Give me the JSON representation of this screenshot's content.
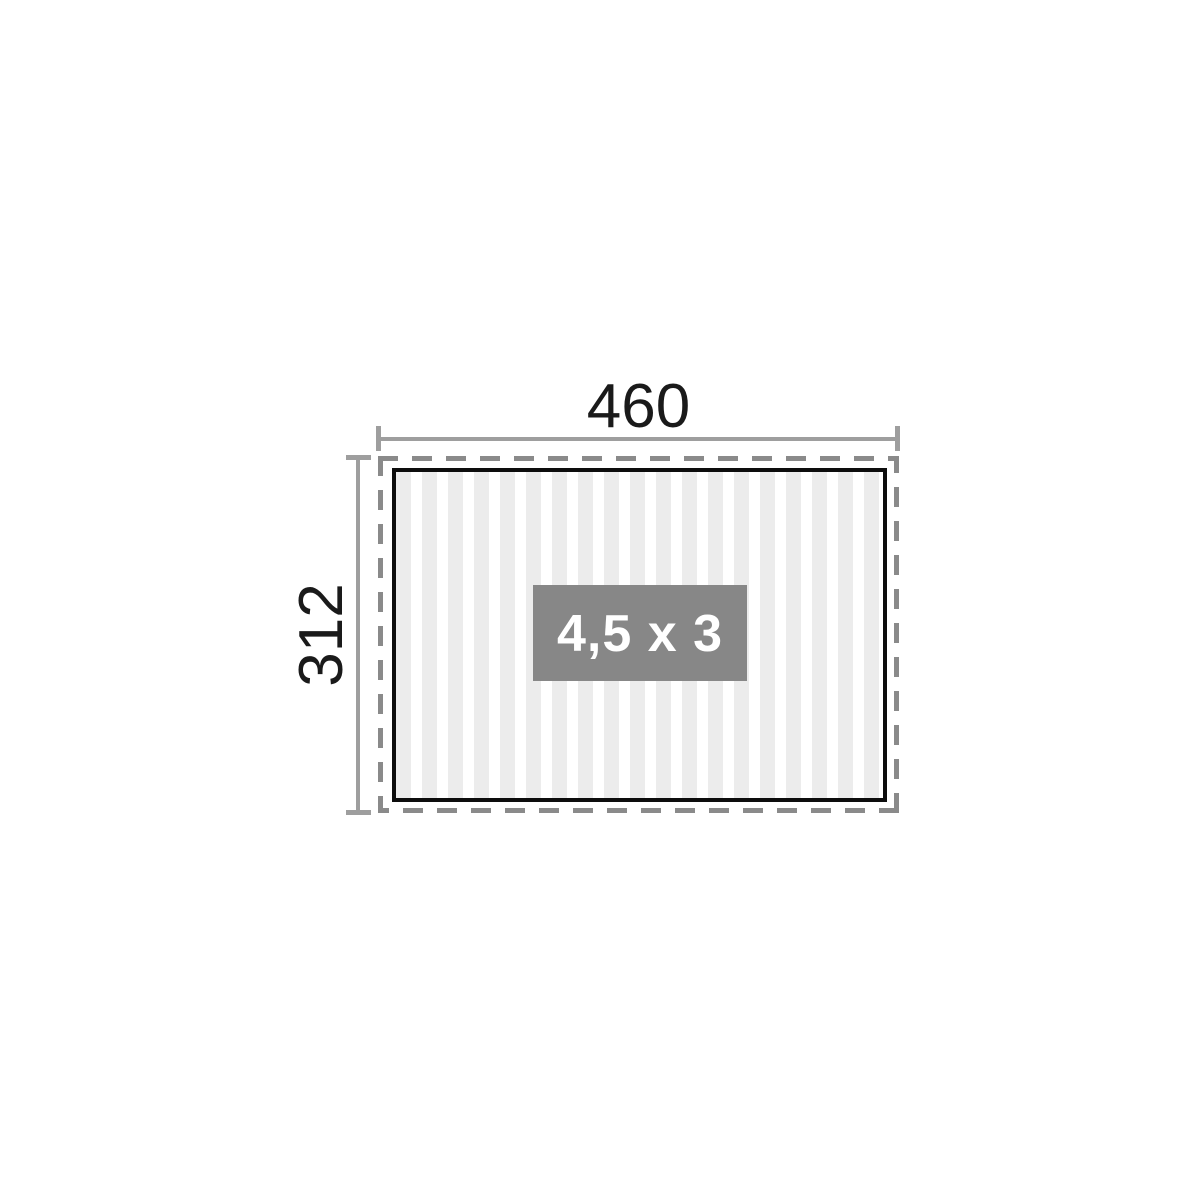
{
  "diagram": {
    "width_dimension_label": "460",
    "height_dimension_label": "312",
    "size_label": "4,5 x 3",
    "colors": {
      "background": "#ffffff",
      "dashed_outline": "#8a8a8a",
      "dimension_line": "#9e9e9e",
      "dimension_text": "#1a1a1a",
      "floor_border": "#0d0d0d",
      "floor_stripe": "#ececec",
      "size_box_background": "#878787",
      "size_box_text": "#ffffff"
    }
  }
}
